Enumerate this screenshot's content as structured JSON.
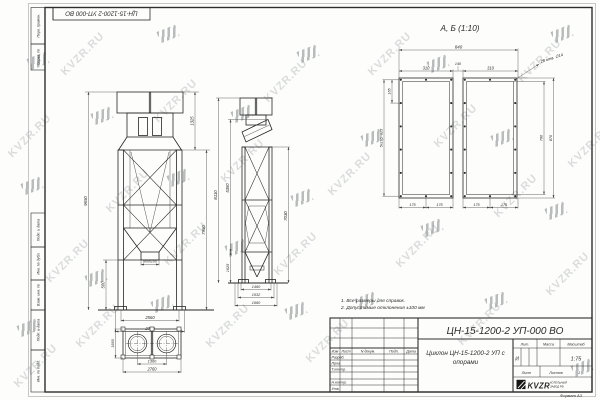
{
  "watermark": {
    "text": "KVZR.RU"
  },
  "sheet": {
    "corner_stamp": "ЦН-15-1200-2 УП-000  ВО",
    "margin_labels": {
      "m1": "Перв. примен.",
      "m2": "Справ. №",
      "m3": "Подп. и дата",
      "m4": "Инв. № дубл.",
      "m5": "Взам. инв. №",
      "m6": "Подп. и дата",
      "m7": "Инв. № подл."
    },
    "format_note": "Формат   А3"
  },
  "notes": {
    "line1": "1.  Все размеры для справок.",
    "line2": "2.  Допустимые отклонения  ±100 мм"
  },
  "views": {
    "front": {
      "dims": {
        "total_height": "9650",
        "top_height": "1325",
        "body_height": "7950",
        "base_height": "500",
        "outlet": "800х100",
        "width_inner": "2560",
        "width_outer": "2760"
      }
    },
    "side": {
      "dims": {
        "total_height": "8110",
        "body_height": "5350",
        "hopper_height": "1625",
        "right_height": "7030",
        "depth1": "1460",
        "depth2": "1532",
        "depth3": "1660"
      }
    },
    "plan": {
      "dims": {
        "centers": "1360",
        "width": "2760",
        "depth": "1660"
      }
    },
    "detail": {
      "title": "А, Б   (1:10)",
      "dims": {
        "total_width": "840",
        "left_width": "310",
        "gap": "140",
        "right_width": "310",
        "holes_note": "28 отв. ∅14",
        "pitch": "165",
        "pitch_chain": "5х165=825",
        "inner_height": "790",
        "outer_height": "870",
        "b1": "175",
        "b2": "175",
        "b3": "175",
        "b4": "175"
      }
    }
  },
  "title_block": {
    "doc_number": "ЦН-15-1200-2 УП-000  ВО",
    "name_line1": "Циклон ЦН-15-1200-2 УП с",
    "name_line2": "опорами",
    "columns": {
      "izm": "Изм",
      "list": "Лист",
      "doc": "N докум.",
      "podp": "Подп.",
      "data": "Дата"
    },
    "rows": {
      "razrab": "Разраб.",
      "prov": "Пров.",
      "tkontr": "Т.контр.",
      "nkontr": "Н.контр.",
      "utv": "Утв."
    },
    "lit_label": "Лит.",
    "lit_value": "И",
    "mass_label": "Масса",
    "scale_label": "Масштаб",
    "scale_value": "1:75",
    "sheet_label": "Лист",
    "sheets_label": "Листов",
    "sheets_value": "1",
    "logo": {
      "name": "KVZR",
      "sub1": "КОТЕЛЬНЫЙ",
      "sub2": "ЗАВОД РФ"
    }
  }
}
